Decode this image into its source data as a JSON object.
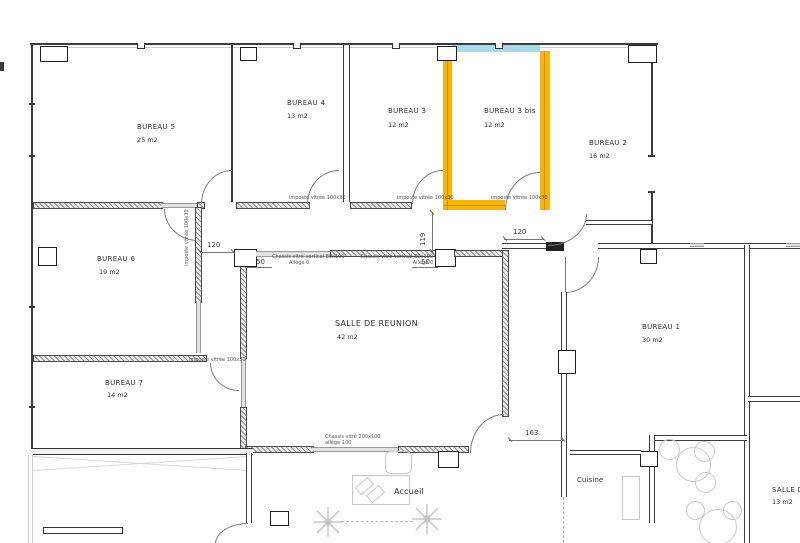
{
  "plan": {
    "highlight_orange": "#F7B50C",
    "highlight_blue": "#A6D9EA"
  },
  "rooms": {
    "bureau5": {
      "name": "BUREAU 5",
      "area": "25 m2"
    },
    "bureau4": {
      "name": "BUREAU 4",
      "area": "13 m2"
    },
    "bureau3": {
      "name": "BUREAU 3",
      "area": "12 m2"
    },
    "bureau3bis": {
      "name": "BUREAU 3 bis",
      "area": "12 m2"
    },
    "bureau2": {
      "name": "BUREAU 2",
      "area": "16 m2"
    },
    "bureau6": {
      "name": "BUREAU 6",
      "area": "19 m2"
    },
    "bureau7": {
      "name": "BUREAU 7",
      "area": "14 m2"
    },
    "bureau1": {
      "name": "BUREAU 1",
      "area": "30 m2"
    },
    "salle_reunion": {
      "name": "SALLE DE REUNION",
      "area": "42 m2"
    },
    "accueil": {
      "name": "Accueil"
    },
    "cuisine": {
      "name": "Cuisine"
    },
    "salle_dejeuner": {
      "name": "SALLE DE",
      "area": "13 m2"
    }
  },
  "annotations": {
    "imposte": "imposte vitrée 100x30",
    "chassis_vertical": "Chassis vitré vertical 80x190",
    "allege_0": "Allège 0",
    "chassis_200": "Chassis vitré 200x100",
    "allege_100": "allège 100"
  },
  "dimensions": {
    "door_b5": "120",
    "corridor": "119",
    "door_b3bis": "120",
    "hall": "163",
    "window_left": "50",
    "window_right": "50"
  }
}
